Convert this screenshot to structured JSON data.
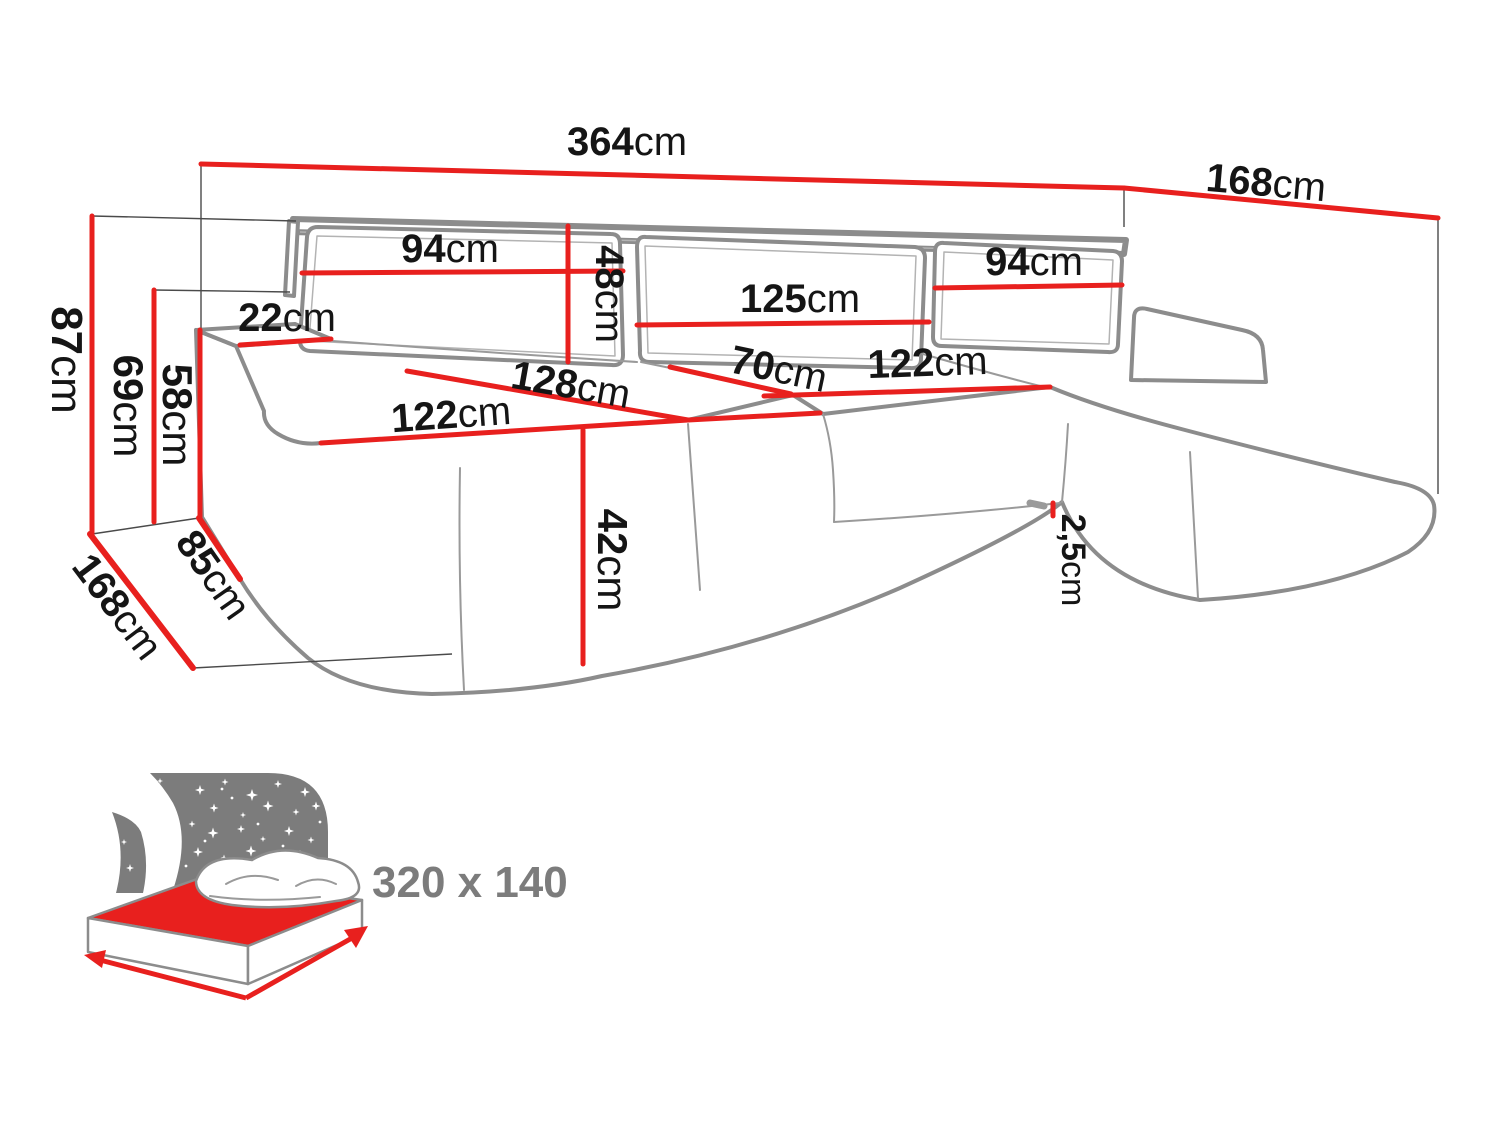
{
  "diagram": {
    "type": "furniture-dimension-diagram",
    "subject": "U-shaped corner sofa with sleeping function"
  },
  "colors": {
    "dimension_line_red": "#e8201e",
    "sofa_outline_gray": "#8c8c8c",
    "label_text_black": "#151515",
    "icon_gray": "#7c7c7c"
  },
  "measurements": {
    "total_width": {
      "value": "364",
      "unit": "cm"
    },
    "right_side_depth": {
      "value": "168",
      "unit": "cm"
    },
    "back_cushion_left": {
      "value": "94",
      "unit": "cm"
    },
    "back_cushion_height": {
      "value": "48",
      "unit": "cm"
    },
    "back_cushion_middle": {
      "value": "125",
      "unit": "cm"
    },
    "back_cushion_right": {
      "value": "94",
      "unit": "cm"
    },
    "armrest_top_width": {
      "value": "22",
      "unit": "cm"
    },
    "total_height": {
      "value": "87",
      "unit": "cm"
    },
    "backrest_height": {
      "value": "69",
      "unit": "cm"
    },
    "armrest_height": {
      "value": "58",
      "unit": "cm"
    },
    "armrest_side_depth": {
      "value": "85",
      "unit": "cm"
    },
    "left_side_depth": {
      "value": "168",
      "unit": "cm"
    },
    "chaise_seat_depth": {
      "value": "128",
      "unit": "cm"
    },
    "chaise_seat_width": {
      "value": "122",
      "unit": "cm"
    },
    "middle_seat_depth": {
      "value": "70",
      "unit": "cm"
    },
    "middle_seat_width": {
      "value": "122",
      "unit": "cm"
    },
    "seat_height": {
      "value": "42",
      "unit": "cm"
    },
    "leg_height": {
      "value": "2,5",
      "unit": "cm"
    }
  },
  "sleeping_function": {
    "bed_size": "320 x 140"
  }
}
